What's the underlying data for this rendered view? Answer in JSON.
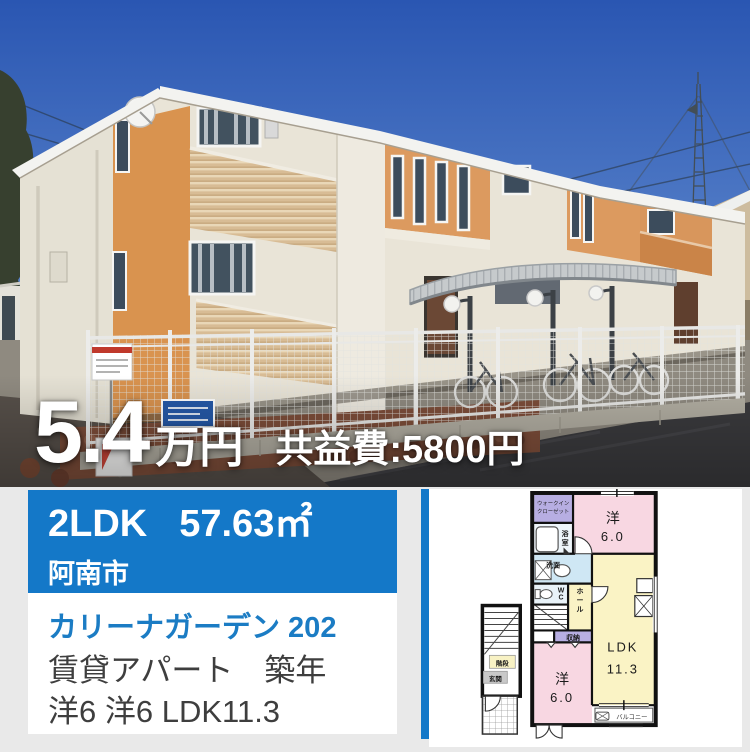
{
  "photo": {
    "price_value": "5.4",
    "price_unit": "万円",
    "maintenance_fee": "共益費:5800円"
  },
  "info_card": {
    "layout": "2LDK",
    "area": "57.63㎡",
    "city": "阿南市",
    "property_name": "カリーナガーデン 202",
    "property_type": "賃貸アパート　築年",
    "rooms_summary": "洋6 洋6 LDK11.3"
  },
  "colors": {
    "accent_blue": "#1478c8",
    "link_blue": "#1b7cc4",
    "plan_pink": "#f8d7e2",
    "plan_yellow": "#faf3c5",
    "plan_lavender": "#b7aee2",
    "plan_lightblue": "#cfe7f4"
  },
  "floor_plan": {
    "labels": {
      "wic": [
        "ウォークイン",
        "クローゼット"
      ],
      "bath": "浴室",
      "wash": "洗面",
      "wc": "WC",
      "hall": "ホール",
      "storage": "収納",
      "room1_label": "洋",
      "room1_size": "6.0",
      "ldk_label": "LDK",
      "ldk_size": "11.3",
      "room2_label": "洋",
      "room2_size": "6.0",
      "stairs": "階段",
      "entrance": "玄関",
      "balcony": "バルコニー"
    }
  }
}
